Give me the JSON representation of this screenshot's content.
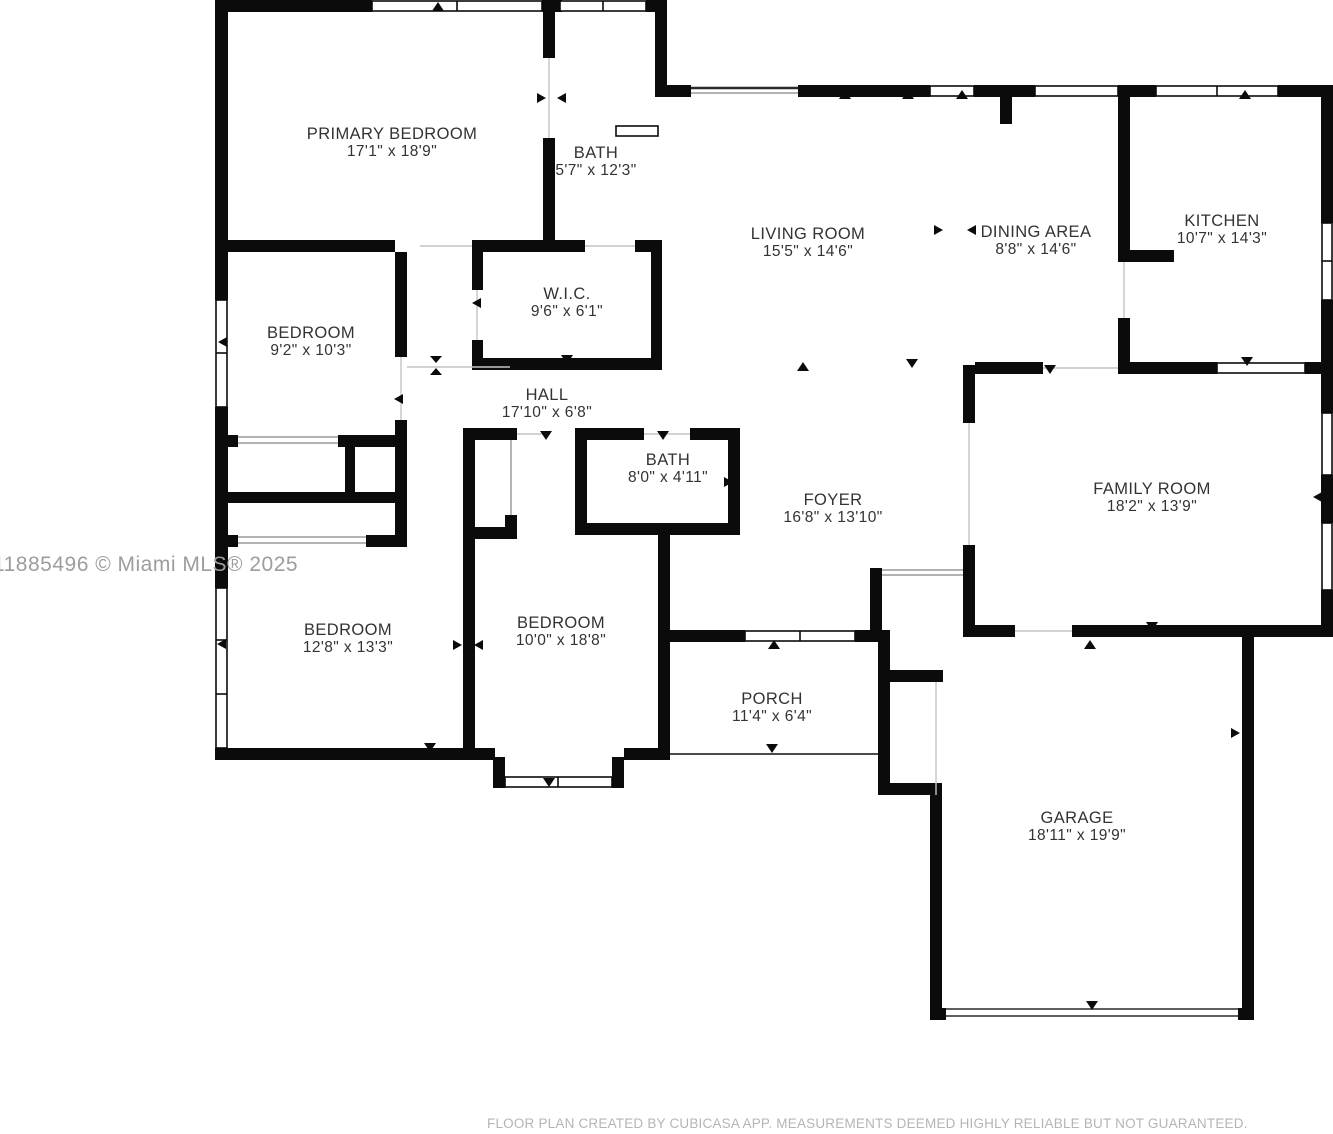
{
  "floor_plan": {
    "background": "#ffffff",
    "wall_color": "#0b0b0b",
    "label_color": "#333333",
    "watermark_color": "#9d9d9d",
    "footer_color": "#b5b5b5",
    "rooms": [
      {
        "id": "primary-bedroom",
        "name": "PRIMARY BEDROOM",
        "dims": "17'1\" x 18'9\"",
        "cx": 392,
        "cy": 143
      },
      {
        "id": "bath-primary",
        "name": "BATH",
        "dims": "5'7\" x 12'3\"",
        "cx": 596,
        "cy": 162
      },
      {
        "id": "living-room",
        "name": "LIVING ROOM",
        "dims": "15'5\" x 14'6\"",
        "cx": 808,
        "cy": 243
      },
      {
        "id": "dining-area",
        "name": "DINING AREA",
        "dims": "8'8\" x 14'6\"",
        "cx": 1036,
        "cy": 241
      },
      {
        "id": "kitchen",
        "name": "KITCHEN",
        "dims": "10'7\" x 14'3\"",
        "cx": 1222,
        "cy": 230
      },
      {
        "id": "bedroom-small",
        "name": "BEDROOM",
        "dims": "9'2\" x 10'3\"",
        "cx": 311,
        "cy": 342
      },
      {
        "id": "wic",
        "name": "W.I.C.",
        "dims": "9'6\" x 6'1\"",
        "cx": 567,
        "cy": 303
      },
      {
        "id": "hall",
        "name": "HALL",
        "dims": "17'10\" x 6'8\"",
        "cx": 547,
        "cy": 404
      },
      {
        "id": "bath-hall",
        "name": "BATH",
        "dims": "8'0\" x 4'11\"",
        "cx": 668,
        "cy": 469
      },
      {
        "id": "foyer",
        "name": "FOYER",
        "dims": "16'8\" x 13'10\"",
        "cx": 833,
        "cy": 509
      },
      {
        "id": "family-room",
        "name": "FAMILY ROOM",
        "dims": "18'2\" x 13'9\"",
        "cx": 1152,
        "cy": 498
      },
      {
        "id": "bedroom-left",
        "name": "BEDROOM",
        "dims": "12'8\" x 13'3\"",
        "cx": 348,
        "cy": 639
      },
      {
        "id": "bedroom-middle",
        "name": "BEDROOM",
        "dims": "10'0\" x 18'8\"",
        "cx": 561,
        "cy": 632
      },
      {
        "id": "porch",
        "name": "PORCH",
        "dims": "11'4\" x 6'4\"",
        "cx": 772,
        "cy": 708
      },
      {
        "id": "garage",
        "name": "GARAGE",
        "dims": "18'11\" x 19'9\"",
        "cx": 1077,
        "cy": 827
      }
    ],
    "watermark": "11885496 © Miami MLS® 2025",
    "footer": "FLOOR PLAN CREATED BY CUBICASA APP. MEASUREMENTS DEEMED HIGHLY RELIABLE BUT NOT GUARANTEED."
  }
}
